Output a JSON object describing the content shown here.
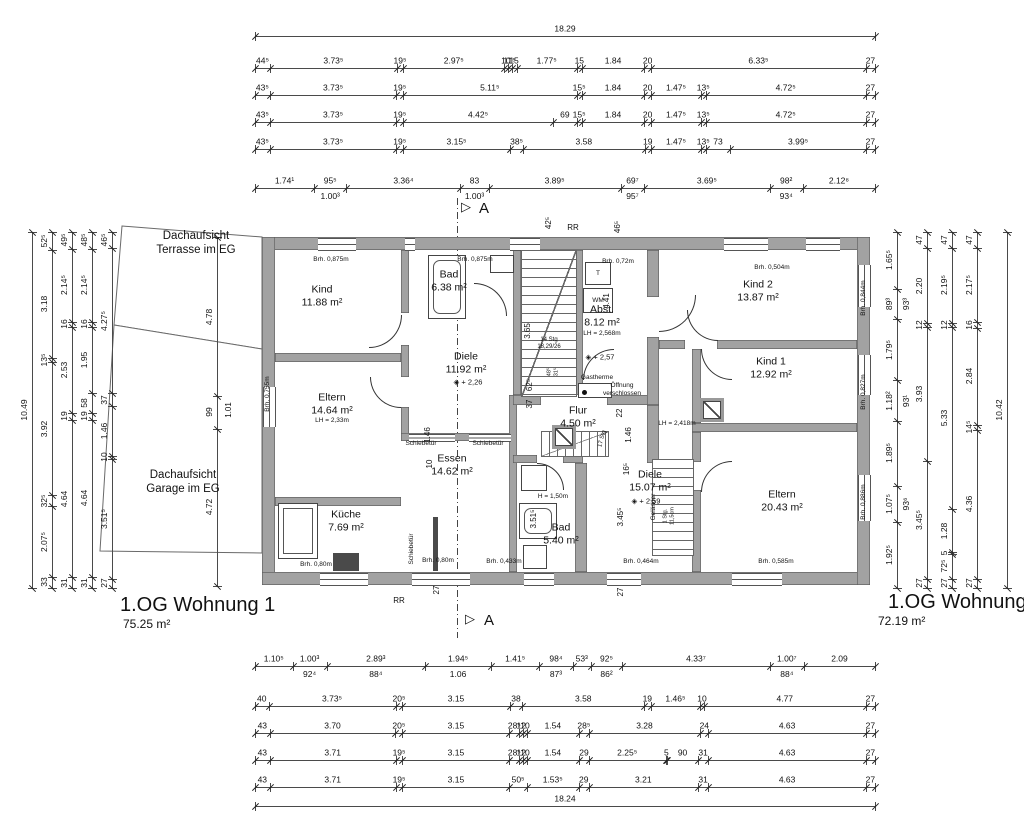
{
  "drawing": {
    "apartment1": {
      "name": "1.OG Wohnung 1",
      "area": "75.25 m²"
    },
    "apartment2": {
      "name": "1.OG Wohnung 2",
      "area": "72.19 m²"
    }
  },
  "colors": {
    "wall_fill": "#a2a2a2",
    "wall_edge": "#5a5a5a",
    "line": "#4a4a4a",
    "text": "#111111"
  },
  "outlines": [
    {
      "name": "terrace-outline",
      "points": "30,8 170,19 170,131 22,107"
    },
    {
      "name": "garage-outline",
      "points": "22,107 170,131 170,335 8,333"
    }
  ],
  "chains": [
    {
      "x": 255,
      "y": 36,
      "len": 620,
      "dir": "h",
      "labels": [
        "18.29"
      ]
    },
    {
      "x": 255,
      "y": 68,
      "len": 620,
      "dir": "h",
      "labels": [
        "44⁵",
        "3.73⁵",
        "19⁵",
        "2.97⁵",
        "10",
        "11⁵",
        "15",
        "1.77⁵",
        "15",
        "1.84",
        "20",
        "6.33⁵",
        "27"
      ]
    },
    {
      "x": 255,
      "y": 95,
      "len": 620,
      "dir": "h",
      "labels": [
        "43⁵",
        "3.73⁵",
        "19⁵",
        "5.11⁵",
        "15⁵",
        "1.84",
        "20",
        "1.47⁵",
        "13⁵",
        "4.72⁵",
        "27"
      ]
    },
    {
      "x": 255,
      "y": 122,
      "len": 620,
      "dir": "h",
      "labels": [
        "43⁵",
        "3.73⁵",
        "19⁵",
        "4.42⁵",
        "69",
        "15⁵",
        "1.84",
        "20",
        "1.47⁵",
        "13⁵",
        "4.72⁵",
        "27"
      ]
    },
    {
      "x": 255,
      "y": 149,
      "len": 620,
      "dir": "h",
      "labels": [
        "43⁵",
        "3.73⁵",
        "19⁵",
        "3.15⁵",
        "38⁵",
        "3.58",
        "19",
        "1.47⁵",
        "13⁵",
        "73",
        "3.99⁵",
        "27"
      ]
    },
    {
      "x": 255,
      "y": 188,
      "len": 620,
      "dir": "h",
      "labels": [
        "1.74¹",
        "95⁵",
        "3.36⁴",
        "83",
        "3.89⁵",
        "69⁷",
        "3.69⁵",
        "98²",
        "2.12⁸"
      ],
      "subs": [
        "",
        "1.00³",
        "",
        "1.00³",
        "",
        "95⁷",
        "",
        "93⁴",
        ""
      ]
    },
    {
      "x": 255,
      "y": 666,
      "len": 620,
      "dir": "h",
      "labels": [
        "1.10⁵",
        "1.00³",
        "2.89³",
        "1.94⁵",
        "1.41⁵",
        "98⁴",
        "53³",
        "92⁵",
        "4.33⁷",
        "1.00⁷",
        "2.09"
      ],
      "subs": [
        "",
        "92⁴",
        "88⁴",
        "1.06",
        "",
        "87³",
        "",
        "86²",
        "",
        "88⁴",
        ""
      ]
    },
    {
      "x": 255,
      "y": 706,
      "len": 620,
      "dir": "h",
      "labels": [
        "40",
        "3.73⁵",
        "20⁵",
        "3.15",
        "38",
        "3.58",
        "19",
        "1.46⁵",
        "10",
        "4.77",
        "27"
      ]
    },
    {
      "x": 255,
      "y": 733,
      "len": 620,
      "dir": "h",
      "labels": [
        "43",
        "3.70",
        "20⁵",
        "3.15",
        "28⁵",
        "12",
        "10",
        "1.54",
        "28⁵",
        "3.28",
        "24",
        "4.63",
        "27"
      ]
    },
    {
      "x": 255,
      "y": 760,
      "len": 620,
      "dir": "h",
      "labels": [
        "43",
        "3.71",
        "19⁵",
        "3.15",
        "28⁵",
        "12",
        "10",
        "1.54",
        "29",
        "2.25⁵",
        "5",
        "90",
        "31",
        "4.63",
        "27"
      ]
    },
    {
      "x": 255,
      "y": 787,
      "len": 620,
      "dir": "h",
      "labels": [
        "43",
        "3.71",
        "19⁵",
        "3.15",
        "50⁵",
        "1.53⁵",
        "29",
        "3.21",
        "31",
        "4.63",
        "27"
      ]
    },
    {
      "x": 255,
      "y": 806,
      "len": 620,
      "dir": "h",
      "labels": [
        "18.24"
      ]
    },
    {
      "x": 32,
      "y": 232,
      "len": 356,
      "dir": "v",
      "labels": [
        "10.49"
      ]
    },
    {
      "x": 52,
      "y": 232,
      "len": 356,
      "dir": "v",
      "labels": [
        "52⁵",
        "3.18",
        "13⁵",
        "3.92",
        "32⁵",
        "2.07⁵",
        "33"
      ]
    },
    {
      "x": 72,
      "y": 232,
      "len": 356,
      "dir": "v",
      "labels": [
        "49⁵",
        "2.14⁵",
        "16",
        "2.53",
        "19",
        "4.64",
        "31"
      ]
    },
    {
      "x": 92,
      "y": 232,
      "len": 356,
      "dir": "v",
      "labels": [
        "48⁵",
        "2.14⁵",
        "16",
        "1.95",
        "58",
        "19",
        "4.64",
        "31"
      ]
    },
    {
      "x": 112,
      "y": 232,
      "len": 356,
      "dir": "v",
      "labels": [
        "46⁵",
        "4.27⁵",
        "37",
        "1.46",
        "10",
        "3.51⁵",
        "27"
      ]
    },
    {
      "x": 897,
      "y": 232,
      "len": 356,
      "dir": "v",
      "labels": [
        "1.65⁵",
        "89³",
        "1.79⁵",
        "1.18²",
        "1.89⁵",
        "1.07⁵",
        "1.92⁵"
      ],
      "subs": [
        "",
        "93³",
        "",
        "93¹",
        "",
        "93⁶",
        ""
      ]
    },
    {
      "x": 927,
      "y": 232,
      "len": 356,
      "dir": "v",
      "labels": [
        "47",
        "2.20",
        "12",
        "3.93",
        "3.45⁵",
        "27"
      ]
    },
    {
      "x": 952,
      "y": 232,
      "len": 356,
      "dir": "v",
      "labels": [
        "47",
        "2.19⁵",
        "12",
        "5.33",
        "1.28",
        "5",
        "72⁵",
        "27"
      ]
    },
    {
      "x": 977,
      "y": 232,
      "len": 356,
      "dir": "v",
      "labels": [
        "47",
        "2.17⁵",
        "16",
        "2.84",
        "14⁵",
        "4.36",
        "27"
      ]
    },
    {
      "x": 1007,
      "y": 232,
      "len": 356,
      "dir": "v",
      "labels": [
        "10.42"
      ]
    },
    {
      "x": 217,
      "y": 237,
      "len": 349,
      "dir": "v",
      "labels": [
        "4.78",
        "99",
        "4.72"
      ]
    }
  ],
  "plan": {
    "x": 262,
    "y": 237,
    "w": 608,
    "h": 348,
    "walls": [
      [
        0,
        0,
        608,
        13
      ],
      [
        0,
        0,
        13,
        348
      ],
      [
        0,
        335,
        608,
        13
      ],
      [
        595,
        0,
        13,
        348
      ],
      [
        13,
        116,
        126,
        9
      ],
      [
        13,
        260,
        126,
        9
      ],
      [
        139,
        13,
        8,
        63
      ],
      [
        139,
        108,
        8,
        32
      ],
      [
        139,
        170,
        8,
        34
      ],
      [
        139,
        196,
        114,
        8
      ],
      [
        247,
        158,
        8,
        177
      ],
      [
        251,
        13,
        8,
        145
      ],
      [
        313,
        13,
        8,
        145
      ],
      [
        251,
        158,
        28,
        10
      ],
      [
        345,
        158,
        52,
        10
      ],
      [
        251,
        218,
        24,
        8
      ],
      [
        301,
        218,
        20,
        8
      ],
      [
        313,
        226,
        12,
        109
      ],
      [
        385,
        13,
        12,
        47
      ],
      [
        385,
        100,
        12,
        68
      ],
      [
        385,
        168,
        12,
        58
      ],
      [
        397,
        103,
        26,
        9
      ],
      [
        455,
        103,
        140,
        9
      ],
      [
        430,
        112,
        9,
        74
      ],
      [
        430,
        186,
        165,
        9
      ],
      [
        430,
        195,
        9,
        30
      ],
      [
        430,
        253,
        9,
        82
      ]
    ],
    "windows": [
      [
        56,
        1,
        38,
        11,
        "h"
      ],
      [
        143,
        1,
        10,
        11,
        "h"
      ],
      [
        248,
        1,
        30,
        11,
        "h"
      ],
      [
        462,
        1,
        44,
        11,
        "h"
      ],
      [
        544,
        1,
        34,
        11,
        "h"
      ],
      [
        1,
        150,
        11,
        40,
        "v"
      ],
      [
        58,
        336,
        48,
        11,
        "h"
      ],
      [
        150,
        336,
        58,
        11,
        "h"
      ],
      [
        262,
        336,
        30,
        11,
        "h"
      ],
      [
        345,
        336,
        34,
        11,
        "h"
      ],
      [
        470,
        336,
        50,
        11,
        "h"
      ],
      [
        596,
        28,
        11,
        42,
        "v"
      ],
      [
        596,
        118,
        11,
        40,
        "v"
      ],
      [
        596,
        238,
        11,
        46,
        "v"
      ],
      [
        147,
        197,
        46,
        6,
        "h"
      ],
      [
        207,
        197,
        42,
        6,
        "h"
      ]
    ],
    "doors": [
      [
        107,
        78,
        32,
        32,
        "br"
      ],
      [
        212,
        46,
        32,
        32,
        "tr"
      ],
      [
        321,
        112,
        30,
        30,
        "tl"
      ],
      [
        397,
        58,
        36,
        36,
        "br"
      ],
      [
        439,
        112,
        30,
        30,
        "bl"
      ],
      [
        439,
        224,
        30,
        30,
        "tl"
      ],
      [
        108,
        140,
        30,
        30,
        "bl"
      ],
      [
        275,
        226,
        26,
        26,
        "tr"
      ],
      [
        425,
        73,
        30,
        30,
        "bl"
      ]
    ],
    "stairs": [
      [
        259,
        13,
        54,
        145,
        "h",
        1
      ],
      [
        279,
        194,
        66,
        24,
        "v",
        1
      ],
      [
        390,
        222,
        40,
        95,
        "h",
        0
      ]
    ],
    "fixtures": [
      {
        "t": "box",
        "x": 323,
        "y": 25,
        "w": 24,
        "h": 21,
        "label": "T"
      },
      {
        "t": "box",
        "x": 321,
        "y": 51,
        "w": 28,
        "h": 23,
        "label": "WM"
      },
      {
        "t": "tub",
        "x": 166,
        "y": 18,
        "w": 36,
        "h": 62
      },
      {
        "t": "box",
        "x": 228,
        "y": 18,
        "w": 22,
        "h": 16,
        "label": ""
      },
      {
        "t": "sink",
        "x": 16,
        "y": 266,
        "w": 38,
        "h": 54
      },
      {
        "t": "dark",
        "x": 71,
        "y": 316,
        "w": 26,
        "h": 18
      },
      {
        "t": "dark",
        "x": 171,
        "y": 280,
        "w": 5,
        "h": 54
      },
      {
        "t": "box",
        "x": 259,
        "y": 228,
        "w": 24,
        "h": 24,
        "label": ""
      },
      {
        "t": "tub",
        "x": 257,
        "y": 266,
        "w": 36,
        "h": 34
      },
      {
        "t": "box",
        "x": 261,
        "y": 308,
        "w": 22,
        "h": 22,
        "label": ""
      },
      {
        "t": "shaft",
        "x": 290,
        "y": 188,
        "w": 24,
        "h": 24
      },
      {
        "t": "shaft",
        "x": 438,
        "y": 161,
        "w": 24,
        "h": 24
      },
      {
        "t": "dot",
        "x": 316,
        "y": 146,
        "w": 32,
        "h": 13
      }
    ]
  },
  "texts": [
    {
      "x": 196,
      "y": 244,
      "s": "Dachaufsicht\nTerrasse im EG",
      "sz": 11.5,
      "n": "terrace-label"
    },
    {
      "x": 183,
      "y": 483,
      "s": "Dachaufsicht\nGarage im EG",
      "sz": 11.5,
      "n": "garage-label"
    },
    {
      "x": 466,
      "y": 207,
      "s": "▷",
      "sz": 13,
      "n": "section-triangle-top"
    },
    {
      "x": 484,
      "y": 209,
      "s": "A",
      "sz": 15,
      "n": "section-letter-top"
    },
    {
      "x": 470,
      "y": 619,
      "s": "▷",
      "sz": 13,
      "n": "section-triangle-bottom"
    },
    {
      "x": 489,
      "y": 621,
      "s": "A",
      "sz": 15,
      "n": "section-letter-bottom"
    },
    {
      "x": 573,
      "y": 228,
      "s": "RR",
      "sz": 8,
      "n": "rr-label-top"
    },
    {
      "x": 399,
      "y": 601,
      "s": "RR",
      "sz": 8,
      "n": "rr-label-bottom"
    },
    {
      "x": 322,
      "y": 296,
      "s": "Kind\n11.88 m²",
      "sz": 10.5,
      "n": "room-kind"
    },
    {
      "x": 449,
      "y": 281,
      "s": "Bad\n6.38 m²",
      "sz": 10.5,
      "n": "room-bad1"
    },
    {
      "x": 466,
      "y": 363,
      "s": "Diele\n11.92 m²",
      "sz": 10.5,
      "n": "room-diele1"
    },
    {
      "x": 468,
      "y": 382,
      "s": "◈ + 2,26",
      "sz": 7.5,
      "n": "level-marker"
    },
    {
      "x": 332,
      "y": 404,
      "s": "Eltern\n14.64 m²",
      "sz": 10.5,
      "n": "room-eltern1"
    },
    {
      "x": 332,
      "y": 421,
      "s": "LH = 2,33m",
      "sz": 6.5,
      "n": "clear-height-note"
    },
    {
      "x": 346,
      "y": 521,
      "s": "Küche\n7.69 m²",
      "sz": 10.5,
      "n": "room-kueche"
    },
    {
      "x": 452,
      "y": 465,
      "s": "Essen\n14.62 m²",
      "sz": 10.5,
      "n": "room-essen"
    },
    {
      "x": 602,
      "y": 316,
      "s": "Abst.\n8.12 m²",
      "sz": 10.5,
      "n": "room-abst"
    },
    {
      "x": 602,
      "y": 334,
      "s": "LH = 2,568m",
      "sz": 6.5,
      "n": "clear-height-note"
    },
    {
      "x": 600,
      "y": 357,
      "s": "◈ + 2,57",
      "sz": 7.5,
      "n": "level-marker"
    },
    {
      "x": 578,
      "y": 417,
      "s": "Flur\n4.50 m²",
      "sz": 10.5,
      "n": "room-flur"
    },
    {
      "x": 561,
      "y": 534,
      "s": "Bad\n5.40 m²",
      "sz": 10.5,
      "n": "room-bad2"
    },
    {
      "x": 758,
      "y": 291,
      "s": "Kind 2\n13.87 m²",
      "sz": 10.5,
      "n": "room-kind2"
    },
    {
      "x": 771,
      "y": 368,
      "s": "Kind 1\n12.92 m²",
      "sz": 10.5,
      "n": "room-kind1"
    },
    {
      "x": 782,
      "y": 501,
      "s": "Eltern\n20.43 m²",
      "sz": 10.5,
      "n": "room-eltern2"
    },
    {
      "x": 650,
      "y": 481,
      "s": "Diele\n15.07 m²",
      "sz": 10.5,
      "n": "room-diele2"
    },
    {
      "x": 646,
      "y": 501,
      "s": "◈ + 2,59",
      "sz": 7.5,
      "n": "level-marker"
    },
    {
      "x": 677,
      "y": 424,
      "s": "LH = 2,418m",
      "sz": 6.5,
      "n": "clear-height-note"
    },
    {
      "x": 331,
      "y": 260,
      "s": "Brh. 0,875m",
      "sz": 6.5,
      "n": "sill-height-note"
    },
    {
      "x": 475,
      "y": 260,
      "s": "Brh. 0,875m",
      "sz": 6.5,
      "n": "sill-height-note"
    },
    {
      "x": 618,
      "y": 262,
      "s": "Brh. 0,72m",
      "sz": 6.5,
      "n": "sill-height-note"
    },
    {
      "x": 772,
      "y": 268,
      "s": "Brh. 0,504m",
      "sz": 6.5,
      "n": "sill-height-note"
    },
    {
      "x": 864,
      "y": 298,
      "s": "Brh. 0,844m",
      "sz": 6.5,
      "r": -90,
      "n": "sill-height-note"
    },
    {
      "x": 864,
      "y": 392,
      "s": "Brh. 0,827m",
      "sz": 6.5,
      "r": -90,
      "n": "sill-height-note"
    },
    {
      "x": 864,
      "y": 502,
      "s": "Brh. 0,886m",
      "sz": 6.5,
      "r": -90,
      "n": "sill-height-note"
    },
    {
      "x": 268,
      "y": 394,
      "s": "Brh. 0,755m",
      "sz": 6.5,
      "r": -90,
      "n": "sill-height-note"
    },
    {
      "x": 438,
      "y": 561,
      "s": "Brh. 0,80m",
      "sz": 6.5,
      "n": "sill-height-note"
    },
    {
      "x": 316,
      "y": 565,
      "s": "Brh. 0,80m",
      "sz": 6.5,
      "n": "sill-height-note"
    },
    {
      "x": 504,
      "y": 562,
      "s": "Brh. 0,433m",
      "sz": 6.5,
      "n": "sill-height-note"
    },
    {
      "x": 641,
      "y": 562,
      "s": "Brh. 0,464m",
      "sz": 6.5,
      "n": "sill-height-note"
    },
    {
      "x": 776,
      "y": 562,
      "s": "Brh. 0,585m",
      "sz": 6.5,
      "n": "sill-height-note"
    },
    {
      "x": 421,
      "y": 444,
      "s": "Schiebetür",
      "sz": 6.5,
      "n": "sliding-door-label"
    },
    {
      "x": 488,
      "y": 444,
      "s": "Schiebetür",
      "sz": 6.5,
      "n": "sliding-door-label"
    },
    {
      "x": 412,
      "y": 549,
      "s": "Schiebetür",
      "sz": 6.5,
      "r": -90,
      "n": "sliding-door-label"
    },
    {
      "x": 549,
      "y": 344,
      "s": "14 Stg\n18,29/26",
      "sz": 6,
      "n": "stair-note"
    },
    {
      "x": 550,
      "y": 372,
      "s": "48⁵",
      "sz": 5.5,
      "r": -90,
      "n": "dim-note"
    },
    {
      "x": 557,
      "y": 372,
      "s": "31⁵",
      "sz": 5.5,
      "r": -90,
      "n": "dim-note"
    },
    {
      "x": 603,
      "y": 439,
      "s": "17 Stg",
      "sz": 6,
      "r": -75,
      "n": "stair-note"
    },
    {
      "x": 669,
      "y": 516,
      "s": "1 Stg.\n11,5cm",
      "sz": 5.5,
      "r": -90,
      "n": "stair-note"
    },
    {
      "x": 654,
      "y": 507,
      "s": "Geländer",
      "sz": 6.5,
      "r": -90,
      "n": "railing-label"
    },
    {
      "x": 597,
      "y": 378,
      "s": "Gastherme",
      "sz": 6.5,
      "n": "gastherme-label"
    },
    {
      "x": 622,
      "y": 390,
      "s": "Öffnung\nverschlossen",
      "sz": 6.5,
      "n": "opening-closed-note"
    },
    {
      "x": 553,
      "y": 497,
      "s": "H = 1,50m",
      "sz": 6.5,
      "n": "height-note"
    },
    {
      "x": 528,
      "y": 331,
      "s": "3.65",
      "sz": 8,
      "r": -90,
      "n": "dim-note"
    },
    {
      "x": 607,
      "y": 301,
      "s": "4.41",
      "sz": 8,
      "r": -90,
      "n": "dim-note"
    },
    {
      "x": 549,
      "y": 223,
      "s": "42⁵",
      "sz": 8,
      "r": -90,
      "n": "dim-note"
    },
    {
      "x": 618,
      "y": 227,
      "s": "46⁵",
      "sz": 8,
      "r": -90,
      "n": "dim-note"
    },
    {
      "x": 530,
      "y": 385,
      "s": "62⁵",
      "sz": 8,
      "r": -90,
      "n": "dim-note"
    },
    {
      "x": 530,
      "y": 404,
      "s": "37",
      "sz": 8,
      "r": -90,
      "n": "dim-note"
    },
    {
      "x": 620,
      "y": 413,
      "s": "22",
      "sz": 8,
      "r": -90,
      "n": "dim-note"
    },
    {
      "x": 428,
      "y": 435,
      "s": "1.46",
      "sz": 8,
      "r": -90,
      "n": "dim-note"
    },
    {
      "x": 629,
      "y": 435,
      "s": "1.46",
      "sz": 8,
      "r": -90,
      "n": "dim-note"
    },
    {
      "x": 430,
      "y": 464,
      "s": "10",
      "sz": 8,
      "r": -90,
      "n": "dim-note"
    },
    {
      "x": 627,
      "y": 469,
      "s": "16⁵",
      "sz": 8,
      "r": -90,
      "n": "dim-note"
    },
    {
      "x": 621,
      "y": 517,
      "s": "3.45⁵",
      "sz": 8,
      "r": -90,
      "n": "dim-note"
    },
    {
      "x": 534,
      "y": 519,
      "s": "3.51⁵",
      "sz": 8,
      "r": -90,
      "n": "dim-note"
    },
    {
      "x": 437,
      "y": 590,
      "s": "27",
      "sz": 8,
      "r": -90,
      "n": "dim-note"
    },
    {
      "x": 621,
      "y": 592,
      "s": "27",
      "sz": 8,
      "r": -90,
      "n": "dim-note"
    },
    {
      "x": 229,
      "y": 410,
      "s": "1.01",
      "sz": 8,
      "r": -90,
      "n": "dim-note"
    }
  ]
}
